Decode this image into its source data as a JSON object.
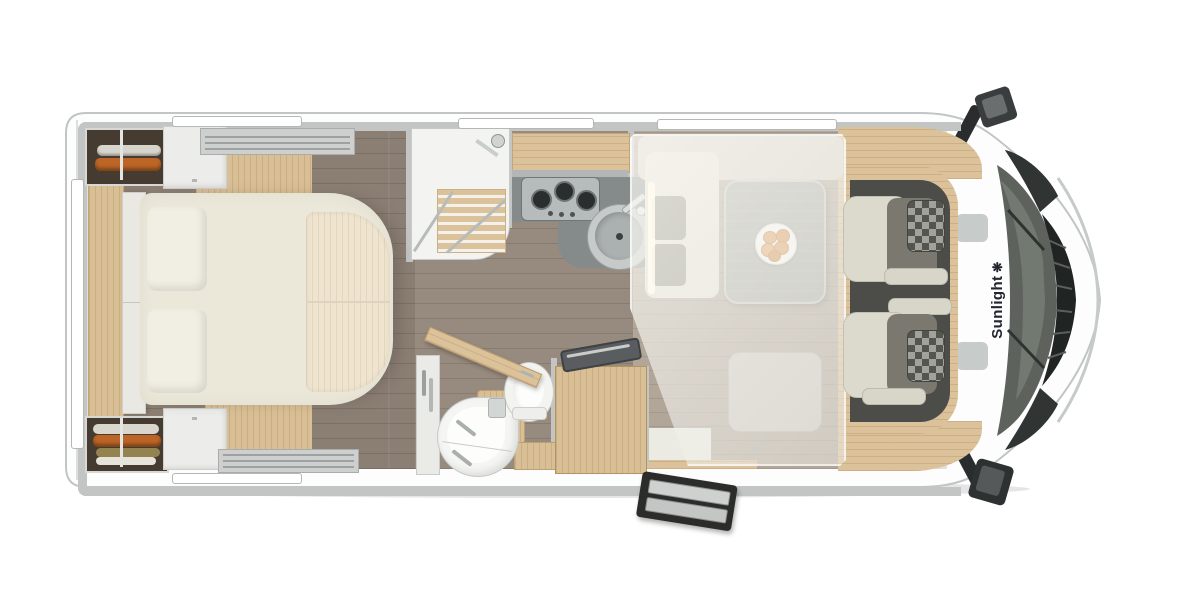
{
  "diagram": {
    "type": "motorhome-floorplan-top-view",
    "orientation": "rear-at-left, cab-at-right"
  },
  "branding": {
    "name": "Sunlight",
    "logo_glyph": "❋",
    "text_color": "#23252f"
  },
  "palette": {
    "body_white": "#fdfdfd",
    "wall_gray": "#c2c5c3",
    "oak_wood": "#dcc29b",
    "floor_dark": "#8b7e73",
    "floor_light": "#b2a698",
    "bed_cream": "#ebe8da",
    "counter_gray": "#858b8b",
    "cab_floor": "#4c4c49",
    "clothes_orange": "#bd6526",
    "drop_bed_overlay": "rgba(246,245,239,0.62)"
  },
  "areas": [
    {
      "name": "rear-bedroom",
      "items": [
        "island-bed",
        "pillows",
        "wardrobe-top",
        "wardrobe-bottom",
        "overhead-cabinets",
        "rear-window"
      ]
    },
    {
      "name": "shower-room",
      "items": [
        "shower-tray",
        "wood-slat-mat",
        "glass-doors",
        "shower-head"
      ]
    },
    {
      "name": "kitchen",
      "items": [
        "overhead-locker",
        "countertop",
        "three-burner-stove",
        "round-sink",
        "faucet"
      ]
    },
    {
      "name": "bathroom",
      "items": [
        "corner-washbasin",
        "toilet",
        "mirror-cabinet",
        "vanity",
        "open-door"
      ]
    },
    {
      "name": "lounge",
      "items": [
        "l-bench",
        "dining-table",
        "plate-of-food",
        "side-bench",
        "drop-down-bed-overlay",
        "entry-door"
      ]
    },
    {
      "name": "cab",
      "items": [
        "driver-seat",
        "passenger-seat",
        "dashboard",
        "windshield",
        "grille",
        "mirror-top",
        "mirror-bottom"
      ]
    }
  ],
  "counts": {
    "top_windows": 3,
    "bottom_windows": 1,
    "roof_vents": 2,
    "cab_seats": 2
  }
}
